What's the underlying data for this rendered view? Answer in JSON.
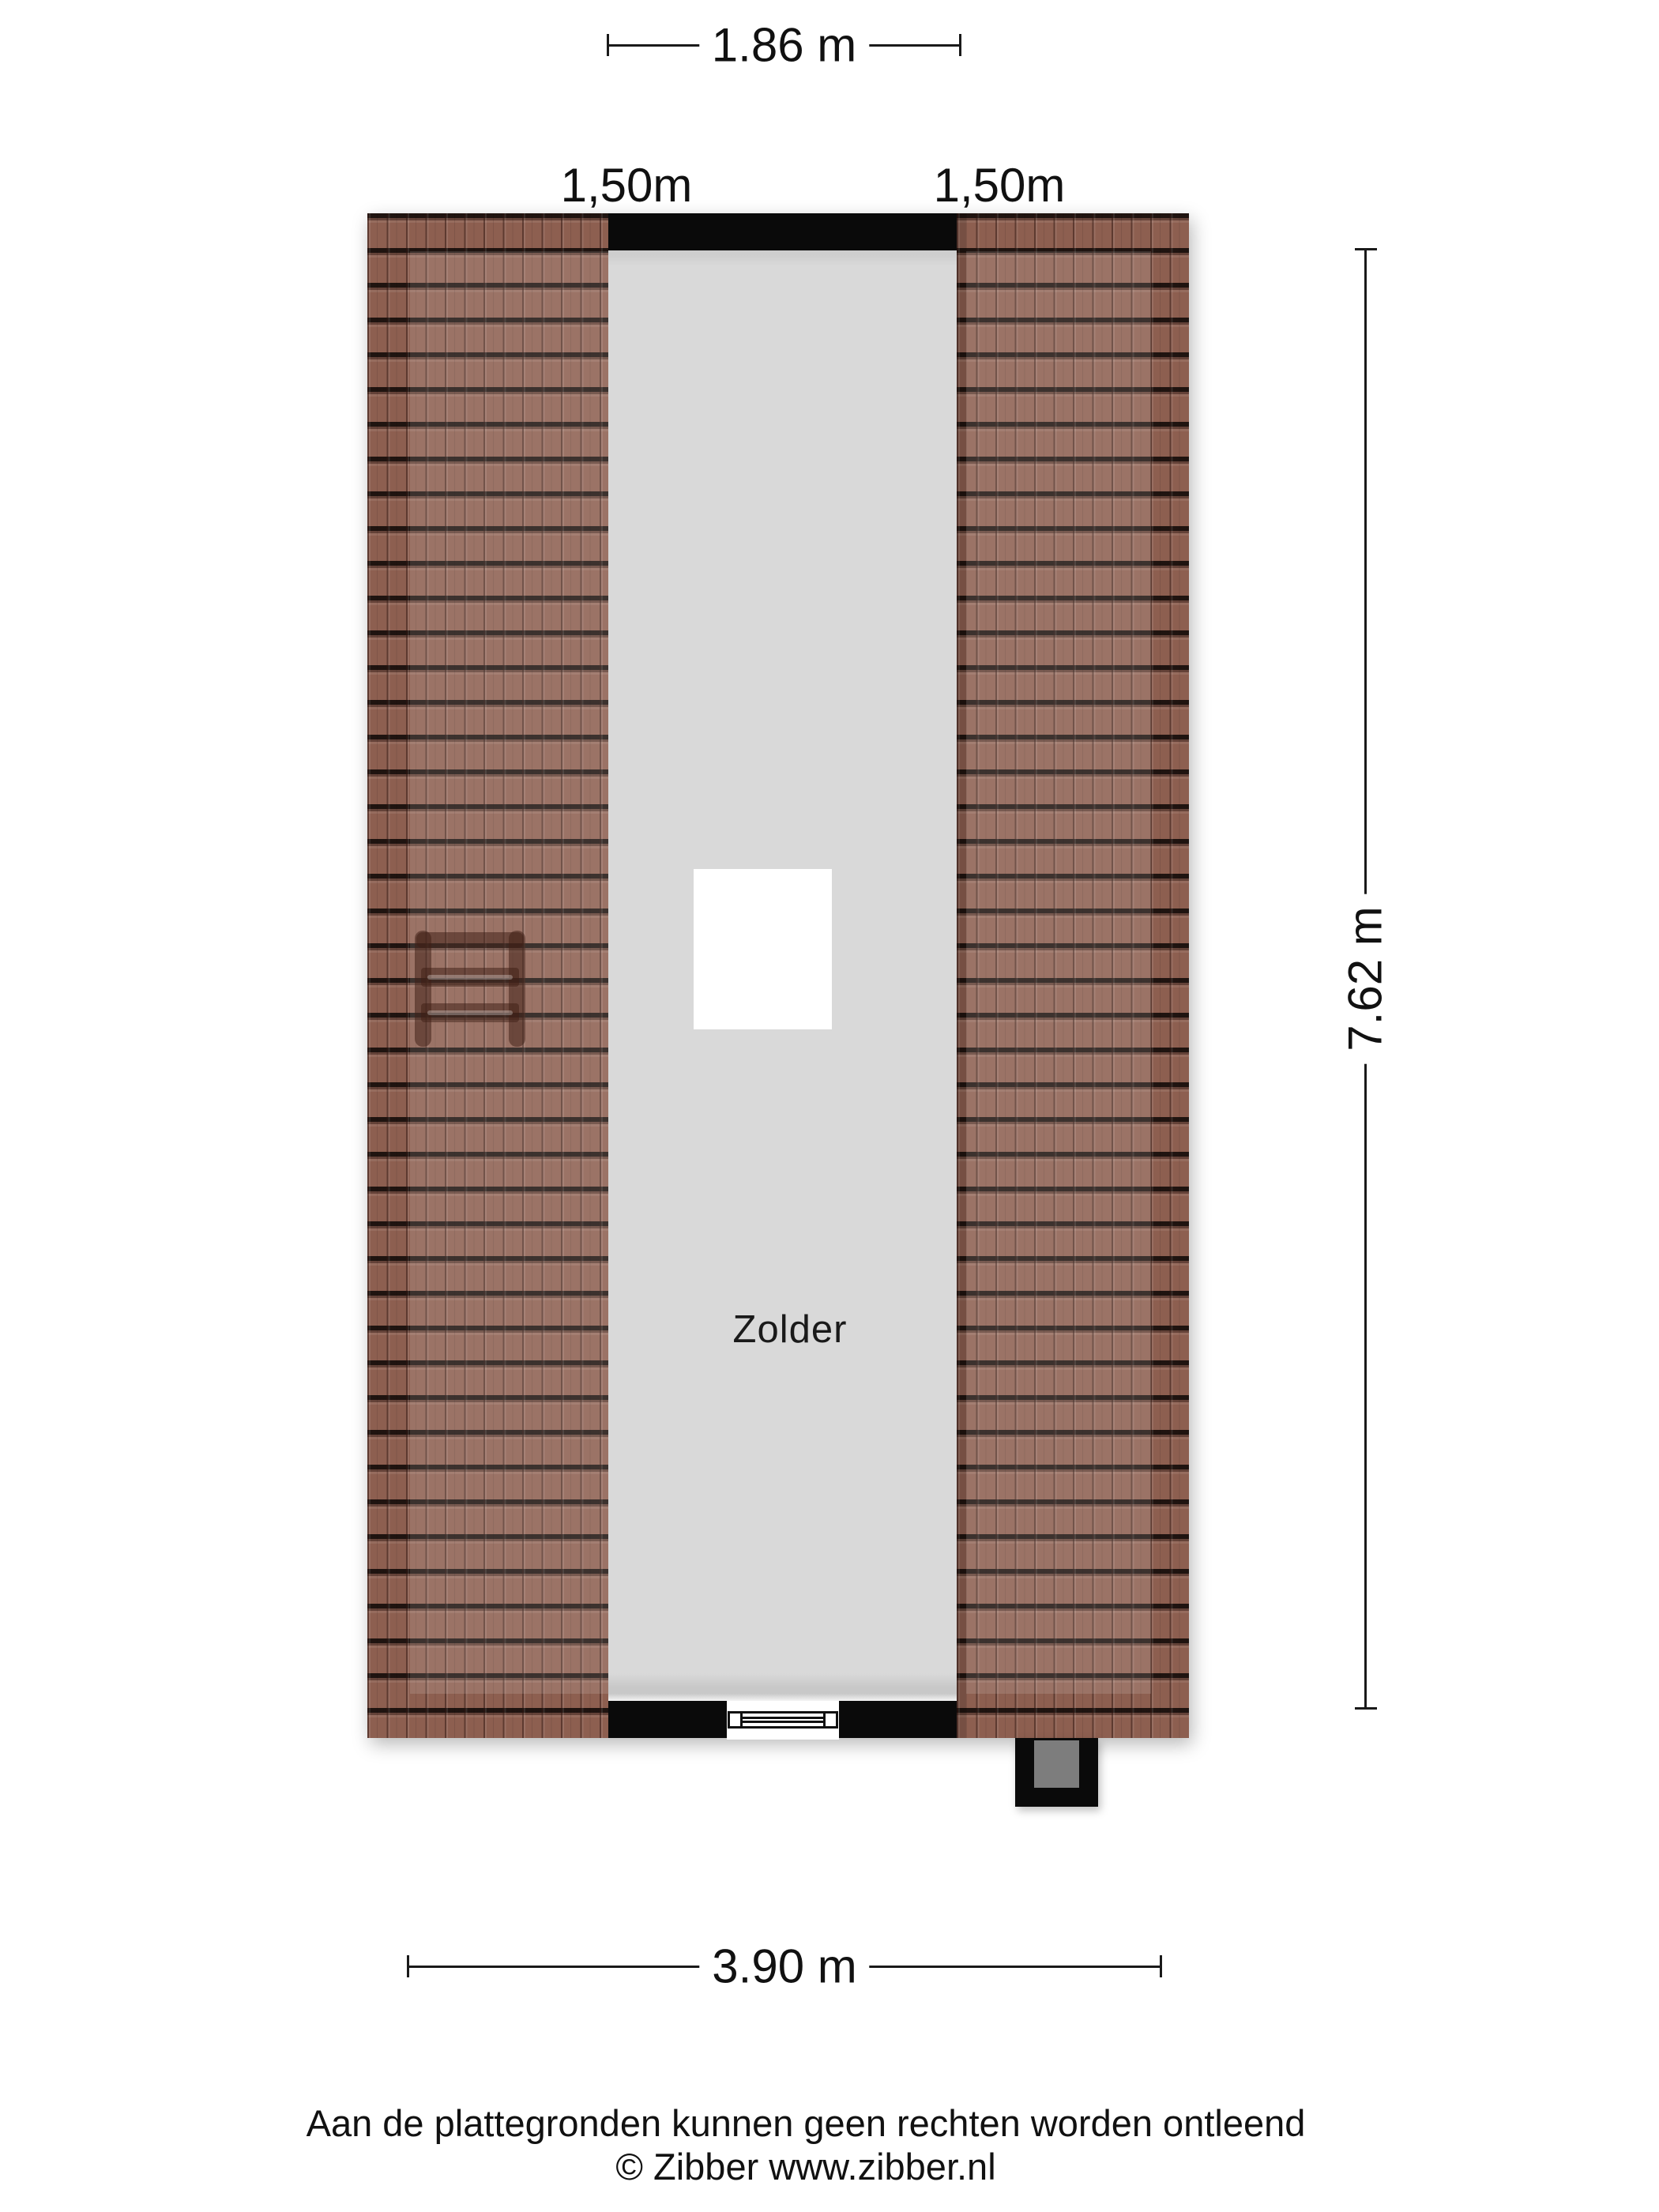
{
  "floorplan": {
    "room": {
      "label": "Zolder"
    },
    "dimensions": {
      "width_top": "1.86 m",
      "knee_left": "1,50m",
      "knee_right": "1,50m",
      "depth_right": "7.62 m",
      "width_bottom": "3.90 m"
    },
    "colors": {
      "roof_tile": "#8d5f50",
      "floor": "#d9d9d9",
      "wall": "#0a0a0a",
      "chimney_inner": "#7d7d7d"
    }
  },
  "footer": {
    "disclaimer": "Aan de plattegronden kunnen geen rechten worden ontleend",
    "credit": "© Zibber www.zibber.nl"
  }
}
